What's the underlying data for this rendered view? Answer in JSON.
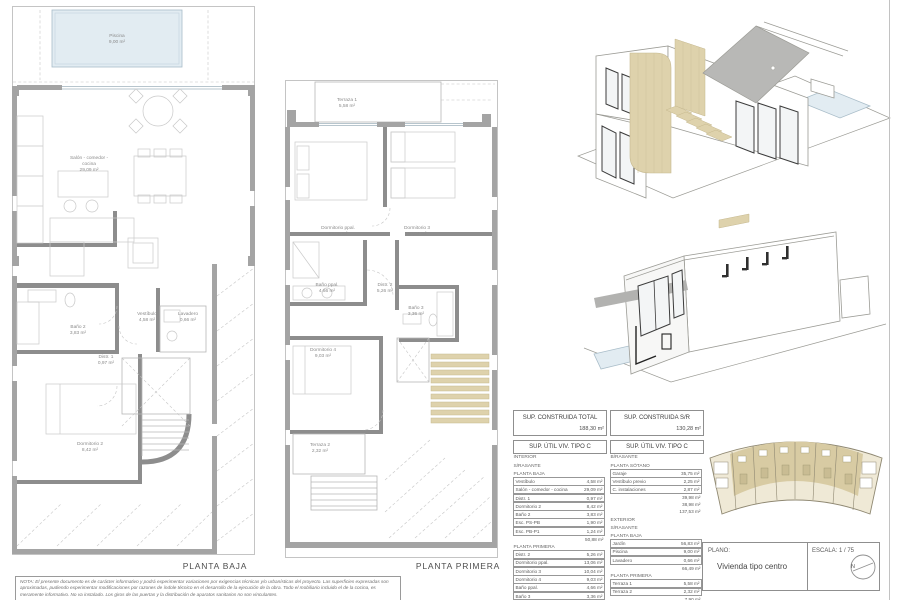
{
  "plans": {
    "baja": {
      "title": "PLANTA BAJA",
      "rooms": {
        "piscina": {
          "name": "Piscina",
          "area": "9,00 m²"
        },
        "salon": {
          "name": "Salón - comedor -",
          "name2": "cocina",
          "area": "29,09 m²"
        },
        "vestibulo": {
          "name": "Vestíbulo",
          "area": "4,58 m²"
        },
        "lavadero": {
          "name": "Lavadero",
          "area": "0,66 m²"
        },
        "bano2": {
          "name": "Baño 2",
          "area": "3,83 m²"
        },
        "distr1": {
          "name": "Distr. 1",
          "area": "0,97 m²"
        },
        "dorm2": {
          "name": "Dormitorio 2",
          "area": "8,42 m²"
        }
      }
    },
    "primera": {
      "title": "PLANTA PRIMERA",
      "rooms": {
        "terraza1": {
          "name": "Terraza 1",
          "area": "5,58 m²"
        },
        "dormppal": {
          "name": "Dormitorio ppal.",
          "area": "13,06 m²"
        },
        "dorm3": {
          "name": "Dormitorio 3",
          "area": "10,04 m²"
        },
        "banoppal": {
          "name": "Baño ppal.",
          "area": "4,66 m²"
        },
        "distr2": {
          "name": "Distr. 2",
          "area": "5,26 m²"
        },
        "bano3": {
          "name": "Baño 3",
          "area": "3,36 m²"
        },
        "dorm4": {
          "name": "Dormitorio 4",
          "area": "9,03 m²"
        },
        "terraza2": {
          "name": "Terraza 2",
          "area": "2,32 m²"
        }
      }
    }
  },
  "summary": {
    "construida_total": {
      "label": "SUP. CONSTRUIDA TOTAL",
      "value": "188,30 m²"
    },
    "construida_sr": {
      "label": "SUP. CONSTRUIDA S/R",
      "value": "130,28 m²"
    },
    "util_left": {
      "title": "SUP. ÚTIL VIV. TIPO C",
      "heading1": "INTERIOR",
      "heading2": "S/RASANTE",
      "group1": {
        "label": "PLANTA BAJA",
        "rows": [
          [
            "Vestíbulo",
            "4,58 m²"
          ],
          [
            "Salón - comedor - cocina",
            "29,09 m²"
          ],
          [
            "Distr. 1",
            "0,97 m²"
          ],
          [
            "Dormitorio 2",
            "8,42 m²"
          ],
          [
            "Baño 2",
            "3,83 m²"
          ],
          [
            "Esc. PS-PB",
            "1,90 m²"
          ],
          [
            "Esc. PB-P1",
            "1,24 m²"
          ],
          "50,88 m²"
        ]
      },
      "group2": {
        "label": "PLANTA PRIMERA",
        "rows": [
          [
            "Distr. 2",
            "5,26 m²"
          ],
          [
            "Dormitorio ppal.",
            "13,06 m²"
          ],
          [
            "Dormitorio 3",
            "10,04 m²"
          ],
          [
            "Dormitorio 4",
            "9,03 m²"
          ],
          [
            "Baño ppal.",
            "4,66 m²"
          ],
          [
            "Baño 3",
            "3,36 m²"
          ],
          [
            "Esc. PB-P1",
            "2,10 m²"
          ],
          "48,17 m²",
          "99,05 m²"
        ]
      }
    },
    "util_right": {
      "title": "SUP. ÚTIL VIV. TIPO C",
      "heading1": "B/RASANTE",
      "group1": {
        "label": "PLANTA SÓTANO",
        "rows": [
          [
            "Garaje",
            "35,75 m²"
          ],
          [
            "Vestíbulo previo",
            "2,25 m²"
          ],
          [
            "C. instalaciones",
            "2,87 m²"
          ],
          "39,98 m²",
          "38,98 m²",
          "137,53 m²"
        ]
      },
      "heading2": "EXTERIOR",
      "heading3": "S/RASANTE",
      "group2": {
        "label": "PLANTA BAJA",
        "rows": [
          [
            "Jardín",
            "56,83 m²"
          ],
          [
            "Piscina",
            "9,00 m²"
          ],
          [
            "Lavadero",
            "0,66 m²"
          ],
          "66,49 m²"
        ]
      },
      "group3": {
        "label": "PLANTA PRIMERA",
        "rows": [
          [
            "Terraza 1",
            "5,58 m²"
          ],
          [
            "Terraza 2",
            "2,32 m²"
          ],
          "7,90 m²",
          "74,39 m²"
        ]
      }
    }
  },
  "titleblock": {
    "plano_label": "PLANO:",
    "plano_value": "Vivienda tipo centro",
    "escala": "ESCALA:  1 / 75",
    "north": "N"
  },
  "note": "NOTA: El presente documento es de carácter informativo y podrá experimentar variaciones por exigencias técnicas y/o urbanísticas del proyecto. Las superficies expresadas son aproximadas, pudiendo experimentar modificaciones por razones de índole técnico en el desarrollo de la ejecución de la obra. Todo el mobiliario incluido el de la cocina, es meramente informativo. No va instalado. Los giros de las puertas y la distribución de aparatos sanitarios no son vinculantes."
}
